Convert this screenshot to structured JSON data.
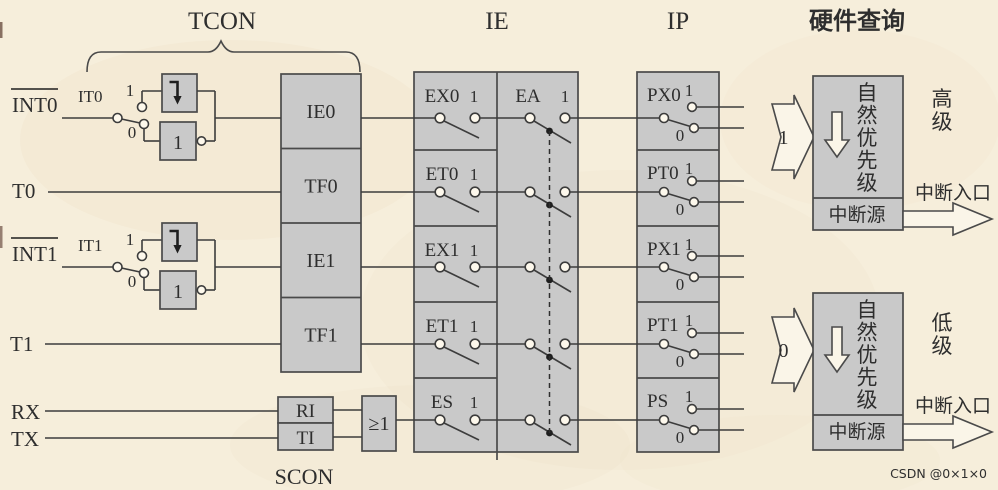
{
  "titles": {
    "tcon": "TCON",
    "ie": "IE",
    "ip": "IP",
    "hw_query": "硬件查询",
    "scon": "SCON"
  },
  "inputs": {
    "int0": "INT0",
    "it0": "IT0",
    "t0": "T0",
    "int1": "INT1",
    "it1": "IT1",
    "t1": "T1",
    "rx": "RX",
    "tx": "TX"
  },
  "tcon_bits": [
    "IE0",
    "TF0",
    "IE1",
    "TF1"
  ],
  "scon_bits": [
    "RI",
    "TI"
  ],
  "or_label": "≥1",
  "ie_bits": [
    "EX0",
    "ET0",
    "EX1",
    "ET1",
    "ES"
  ],
  "ea_label": "EA",
  "ip_bits": [
    "PX0",
    "PT0",
    "PX1",
    "PT1",
    "PS"
  ],
  "binary": {
    "one": "1",
    "zero": "0"
  },
  "priority": {
    "natural": "自然优先级",
    "source": "中断源",
    "entry": "中断入口",
    "high": {
      "input": "1",
      "level": "高级"
    },
    "low": {
      "input": "0",
      "level": "低级"
    }
  },
  "watermark": "CSDN @0×1×0",
  "colors": {
    "background": "#f6eedb",
    "box_fill": "#c9c9c9",
    "box_stroke": "#4a4a4a",
    "wire": "#3c3c3c",
    "arrow_fill": "#faf5e8",
    "text": "#2e2e2e",
    "watermark": "#a49e92"
  }
}
